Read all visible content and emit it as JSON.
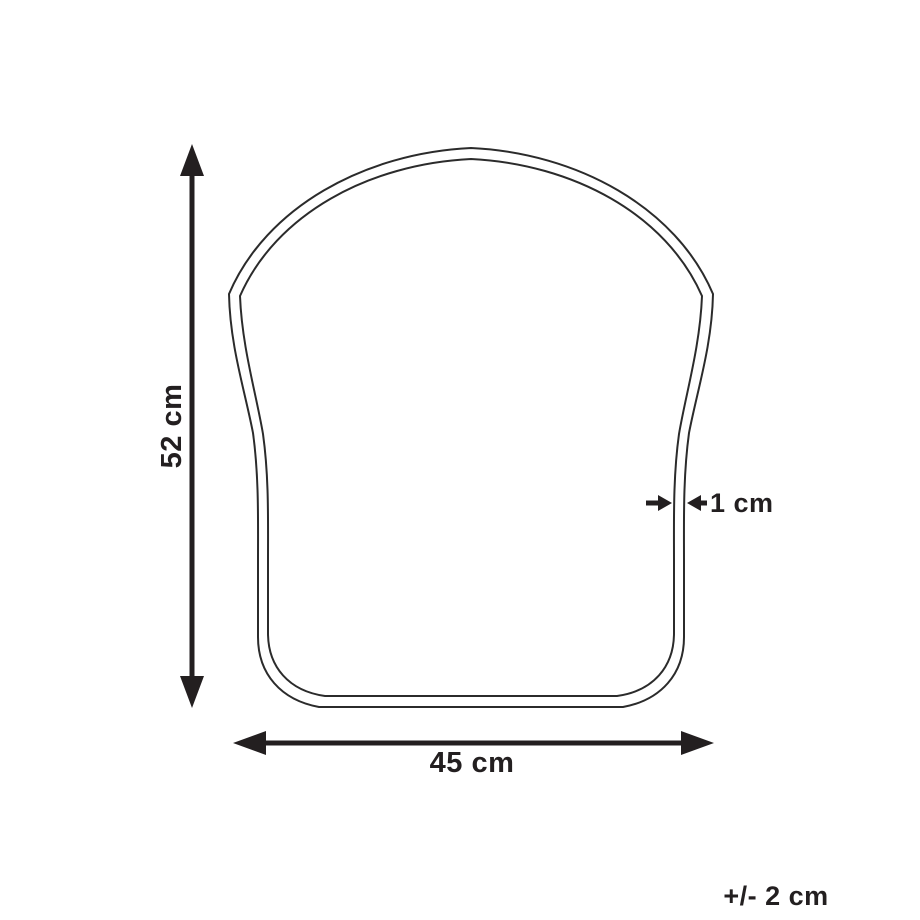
{
  "figure": {
    "type": "product-dimension-diagram",
    "subject": "seat-cushion-outline",
    "background_color": "#ffffff",
    "line_color": "#231f20",
    "outline_color": "#2b2b2b"
  },
  "dimensions": {
    "height": {
      "label": "52 cm",
      "orientation": "vertical"
    },
    "width": {
      "label": "45 cm",
      "orientation": "horizontal"
    },
    "thickness": {
      "label": "1 cm",
      "orientation": "horizontal"
    },
    "tolerance": {
      "label": "+/- 2 cm"
    }
  }
}
